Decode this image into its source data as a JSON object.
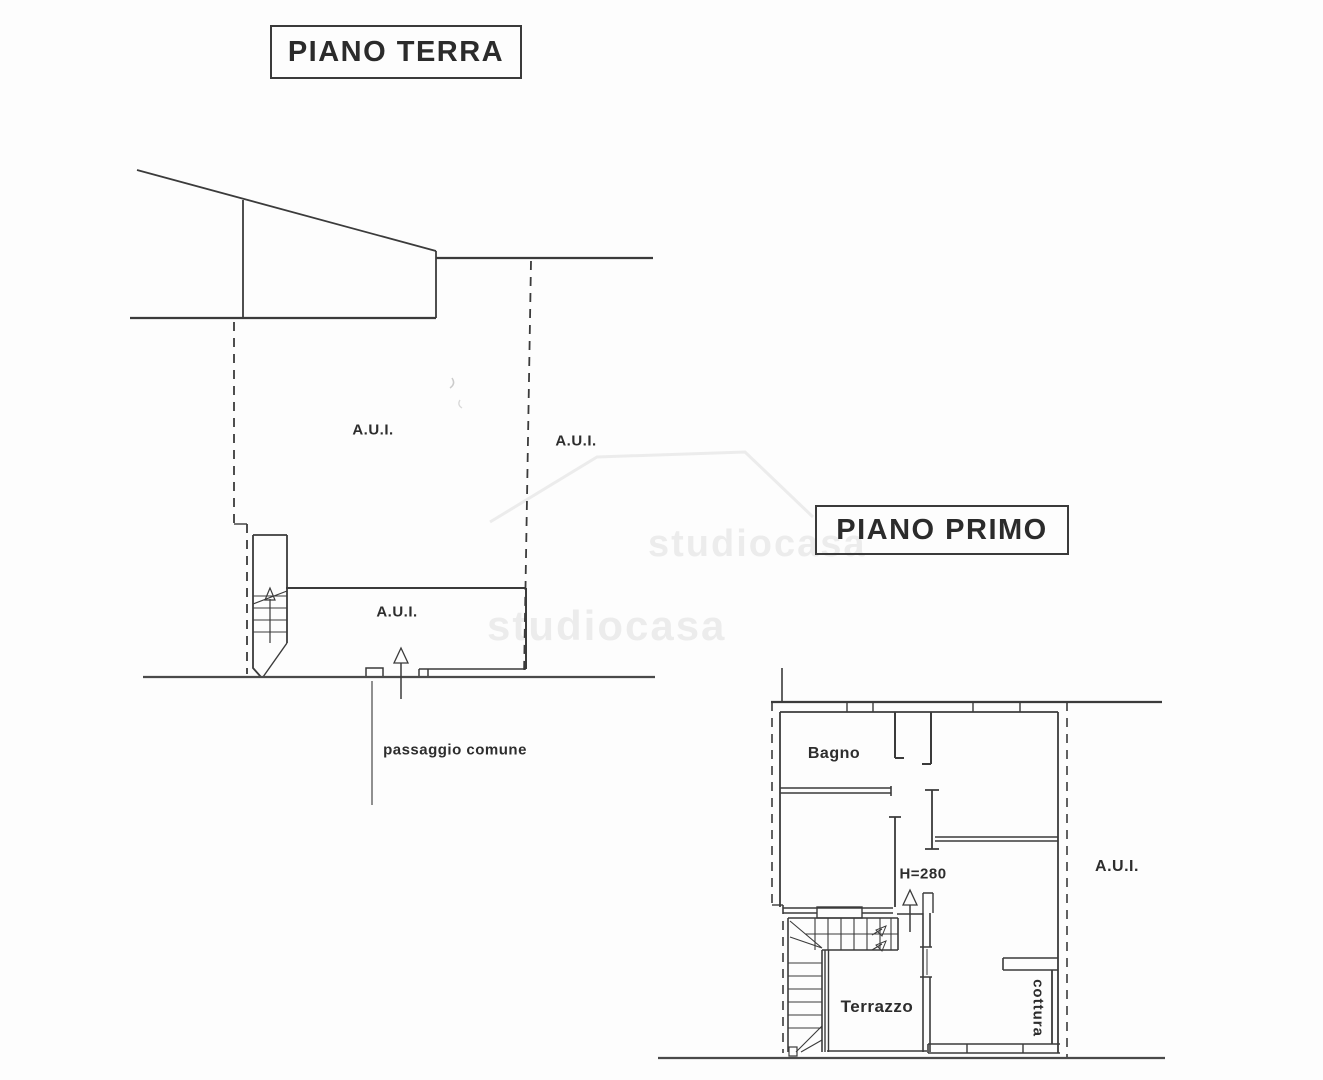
{
  "ground_floor": {
    "title": "PIANO TERRA",
    "labels": {
      "aui_upper_left": "A.U.I.",
      "aui_upper_right": "A.U.I.",
      "aui_room": "A.U.I.",
      "passaggio_comune": "passaggio comune"
    }
  },
  "first_floor": {
    "title": "PIANO PRIMO",
    "labels": {
      "bagno": "Bagno",
      "aui_right": "A.U.I.",
      "height_note": "H=280",
      "terrazzo": "Terrazzo",
      "cottura": "cottura"
    }
  },
  "watermark": {
    "text": "studiocasa"
  },
  "colors": {
    "line": "#3b3b3b",
    "background": "#fdfdfd",
    "text": "#2d2d2d"
  }
}
